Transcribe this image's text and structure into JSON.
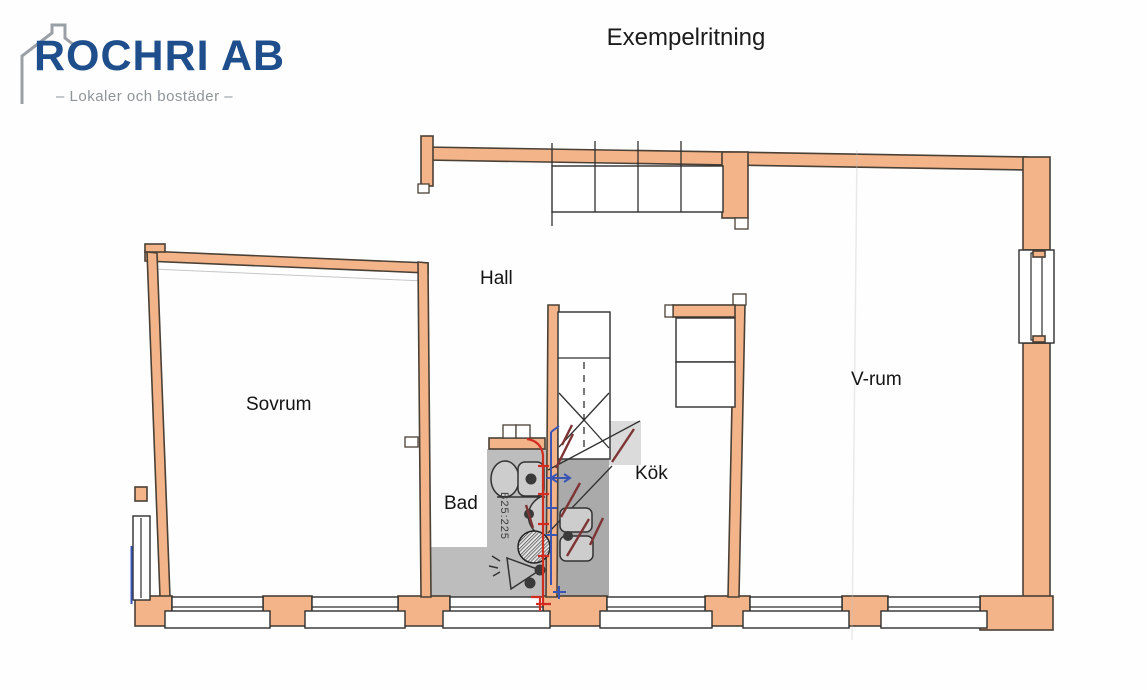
{
  "header": {
    "logo_name": "ROCHRI AB",
    "logo_tagline": "– Lokaler och bostäder –",
    "title": "Exempelritning"
  },
  "plan": {
    "rooms": {
      "hall": "Hall",
      "sovrum": "Sovrum",
      "bad": "Bad",
      "kok": "Kök",
      "vrum": "V-rum"
    },
    "annotations": {
      "pipe_label": "B25:225"
    },
    "colors": {
      "wall": "#f2b488",
      "wall_outline": "#4a4036",
      "shade": "#bdbdbd",
      "shade_dark": "#aaaaaa",
      "pipe_hot": "#d22b1f",
      "pipe_cold": "#3b55b5",
      "pipe_dark": "#7e3434",
      "logo_blue": "#1e4e8b",
      "logo_gray": "#8f9499"
    }
  }
}
